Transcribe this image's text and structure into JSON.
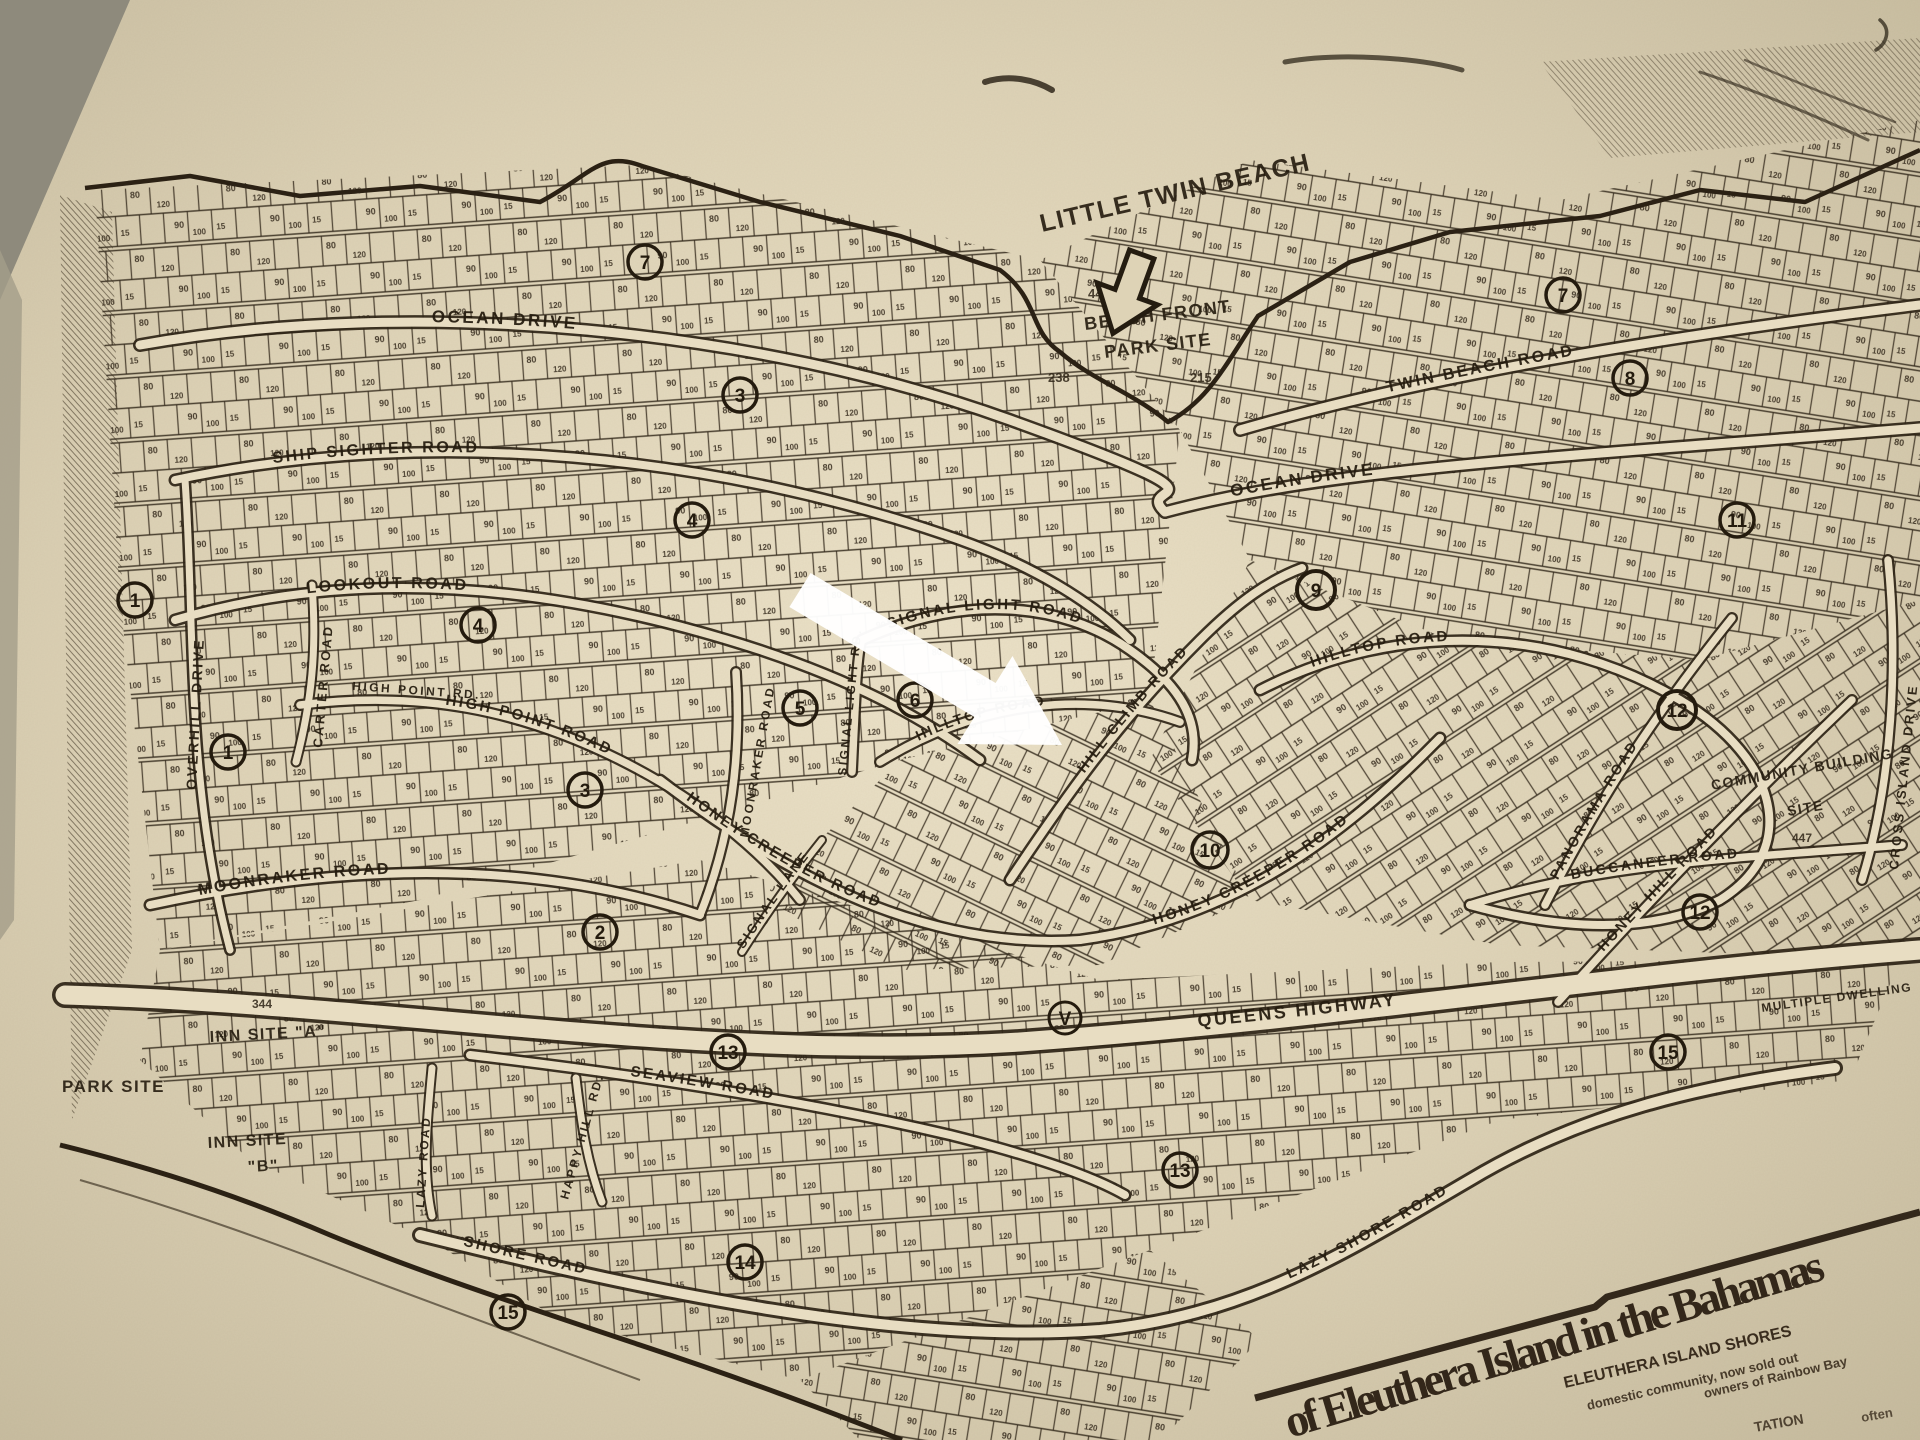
{
  "colors": {
    "paper_light": "#ece2c8",
    "paper_mid": "#dbd0b4",
    "paper_edge": "#c6bb9e",
    "ink": "#2e2416",
    "road_fill": "#e8ddc2",
    "corner_shadow": "#8e8a7c",
    "arrow": "#ffffff"
  },
  "beach_label": "LITTLE TWIN BEACH",
  "roads": {
    "ocean_w": "OCEAN DRIVE",
    "ocean_e": "OCEAN DRIVE",
    "ship_sighter": "SHIP SIGHTER ROAD",
    "lookout": "LOOKOUT ROAD",
    "overhill": "OVERHILL DRIVE",
    "carter": "CARTER ROAD",
    "high_point_sm": "HIGH POINT RD.",
    "high_point": "HIGH POINT ROAD",
    "moonraker": "MOONRAKER ROAD",
    "moonraker_v": "MOONRAKER ROAD",
    "signal_light": "SIGNAL LIGHT ROAD",
    "signal_light_v": "SIGNAL LIGHT RD.",
    "signal_lane": "SIGNAL LANE",
    "hill_climb": "HILL CLIMB ROAD",
    "hilltop_c": "HILLTOP ROAD",
    "hilltop_e": "HILLTOP ROAD",
    "honey_creeper_c": "HONEY CREEPER ROAD",
    "honey_creeper_e": "HONEY CREEPER ROAD",
    "queens": "QUEENS HIGHWAY",
    "seaview": "SEAVIEW ROAD",
    "happy_hill": "HAPPY HILL RD.",
    "lazy_v": "LAZY ROAD",
    "shore_w": "SHORE ROAD",
    "lazy_shore": "LAZY SHORE ROAD",
    "twin_beach": "TWIN BEACH ROAD",
    "panorama": "PANORAMA ROAD",
    "honey_hill": "HONEY HILL ROAD",
    "buccaneer": "BUCCANEER ROAD",
    "cross_island": "CROSS ISLAND DRIVE"
  },
  "sites": {
    "beach_front_1": "BEACH FRONT",
    "beach_front_2": "PARK SITE",
    "community_1": "COMMUNITY BUILDING",
    "community_2": "SITE",
    "park_site": "PARK SITE",
    "inn_site_a": "INN SITE \"A\"",
    "inn_site_b_1": "INN SITE",
    "inn_site_b_2": "\"B\"",
    "multiple_dwelling": "MULTIPLE DWELLING"
  },
  "numbers": {
    "n447": "447",
    "n447b": "447",
    "n215": "215",
    "n238": "238",
    "n344": "344"
  },
  "markers": [
    "7",
    "3",
    "4",
    "4",
    "1",
    "1",
    "3",
    "5",
    "6",
    "2",
    "9",
    "10",
    "V",
    "7",
    "8",
    "11",
    "12",
    "12",
    "15",
    "13",
    "13",
    "14",
    "15"
  ],
  "texture": {
    "dims": [
      "80",
      "120",
      "90",
      "15",
      "100"
    ]
  },
  "title": {
    "main": "of Eleuthera Island in the Bahamas",
    "sub1": "ELEUTHERA ISLAND SHORES",
    "sub2": "domestic community, now sold out",
    "sub3": "owners of Rainbow Bay",
    "sub4": "TATION",
    "sub5": "often"
  }
}
